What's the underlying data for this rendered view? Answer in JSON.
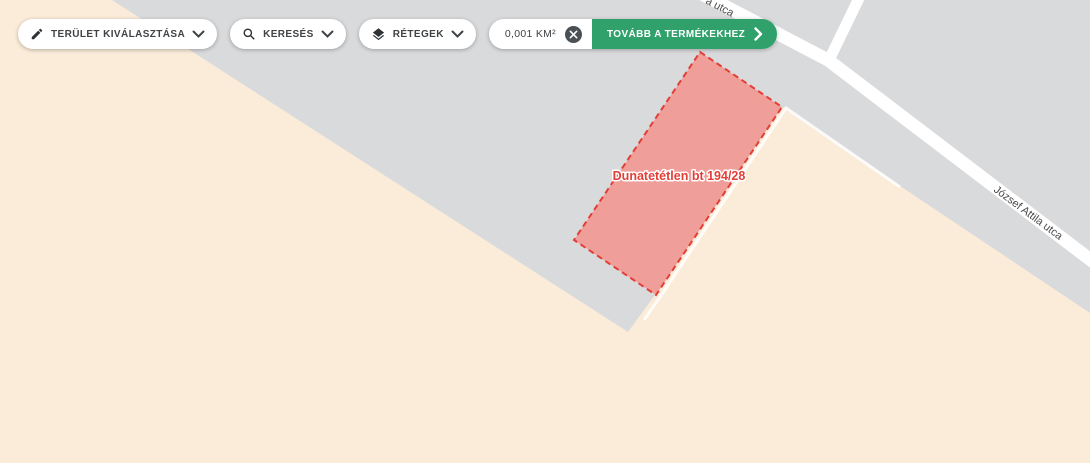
{
  "toolbar": {
    "area_select": {
      "label": "TERÜLET KIVÁLASZTÁSA"
    },
    "search": {
      "label": "KERESÉS"
    },
    "layers": {
      "label": "RÉTEGEK"
    },
    "area_badge": {
      "value": "0,001 KM²"
    },
    "proceed": {
      "label": "TOVÁBB A TERMÉKEKHEZ",
      "color": "#31a16c"
    }
  },
  "map": {
    "colors": {
      "land": "#fbecd9",
      "built_area": "#d9dadc",
      "road": "#ffffff"
    },
    "parcel": {
      "label": "Dunatetétlen bt 194/28",
      "fill": "#ff7369",
      "border": "#e23e36",
      "label_color": "#e23e36"
    },
    "streets": {
      "main": "József Attila utca",
      "top_partial": "a utca"
    }
  }
}
